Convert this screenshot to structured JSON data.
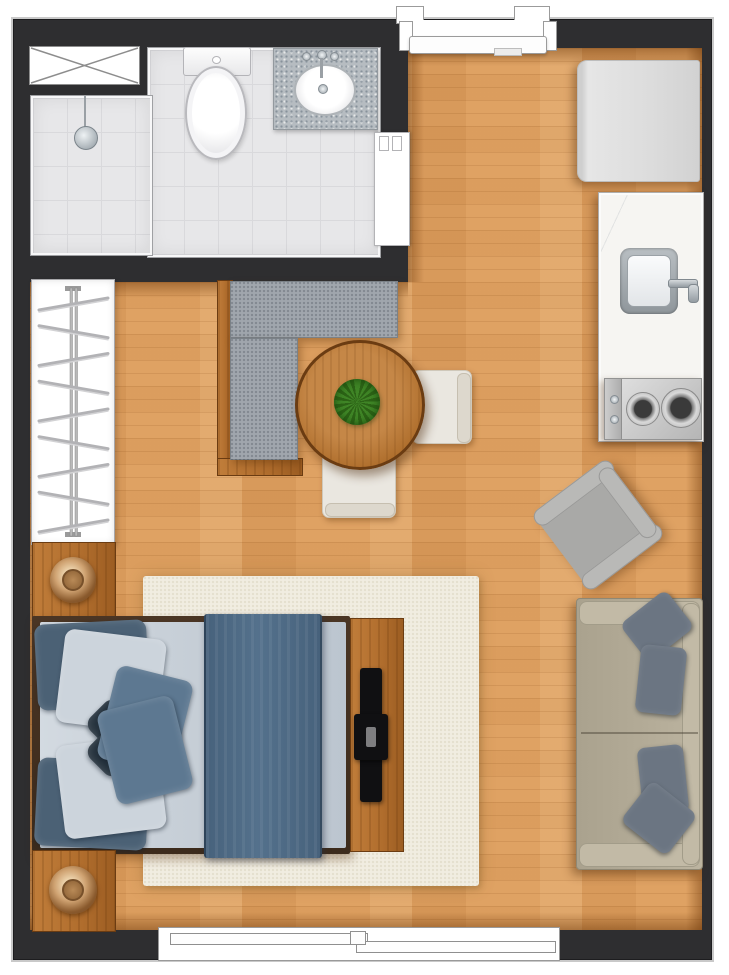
{
  "meta": {
    "kind": "floor-plan",
    "view": "top-down",
    "unit": "studio-apartment",
    "visible_text": "none"
  },
  "colors": {
    "wall": "#2e2e30",
    "outline": "#c9c9c9",
    "wood": "#dfa263",
    "wood_dark": "#b97a33",
    "tile": "#e7e7e9",
    "tile_line": "#d9d9dc",
    "granite": "#b6bcc1",
    "marble": "#f6f5f2",
    "steel": "#a9adb0",
    "fridge": "#dedede",
    "furniture_wood": "#b06d2d",
    "bed_frame": "#3c2b1c",
    "mattress": "#c8d0d8",
    "runner": "#54718c",
    "pillow_dark": "#4b6175",
    "pillow_light": "#ccd4dc",
    "pillow_mid": "#5d7891",
    "pillow_navy": "#27343f",
    "rug": "#f1ede1",
    "bench": "#a0a6ad",
    "armchair": "#a9a9a7",
    "armchair_light": "#b9b9b7",
    "sofa": "#b3ab97",
    "sofa_light": "#c2baa6",
    "sofa_pillow": "#6b7582",
    "chair": "#eae7e0",
    "plant": "#3f8526",
    "plant_dark": "#2c6316"
  },
  "wardrobe": {
    "hanger_count": 9
  },
  "rooms": [
    {
      "name": "bathroom",
      "fixtures": [
        "utility-shaft",
        "shower",
        "toilet",
        "vanity-sink"
      ]
    },
    {
      "name": "kitchen",
      "fixtures": [
        "refrigerator",
        "counter-with-sink",
        "two-burner-cooktop"
      ]
    },
    {
      "name": "living-dining",
      "furniture": [
        "l-shaped-bench",
        "round-dining-table",
        "potted-plant",
        "dining-chair-right",
        "dining-chair-bottom",
        "armchair",
        "two-seat-sofa"
      ]
    },
    {
      "name": "sleeping-area",
      "furniture": [
        "open-wardrobe",
        "nightstand-with-lamp",
        "double-bed",
        "bed-runner",
        "tv-panel",
        "nightstand-with-lamp",
        "area-rug"
      ]
    }
  ],
  "openings": [
    {
      "name": "entry-door",
      "wall": "top"
    },
    {
      "name": "bathroom-sliding-door",
      "wall": "bathroom-right"
    },
    {
      "name": "sliding-window",
      "wall": "bottom"
    }
  ]
}
